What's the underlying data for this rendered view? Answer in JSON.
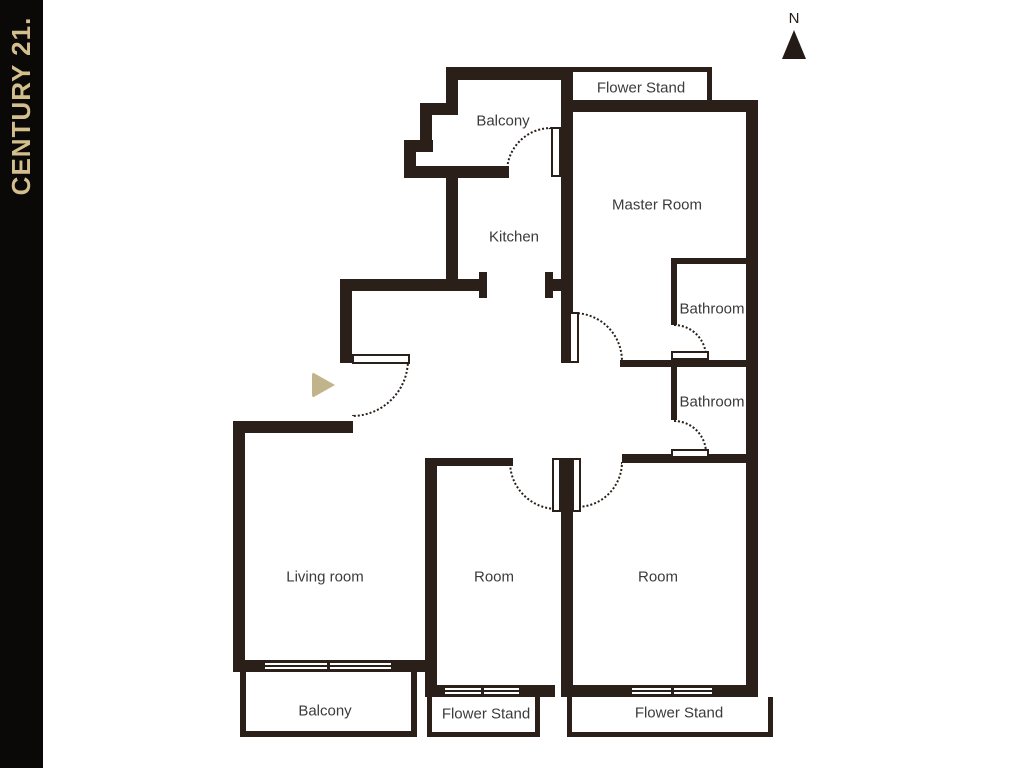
{
  "brand": {
    "text": "CENTURY 21.",
    "bar_color": "#0b0907",
    "text_color": "#d3bf8e"
  },
  "compass": {
    "label": "N"
  },
  "palette": {
    "wall": "#2b2019",
    "label_text": "#3b3b3b",
    "entrance_marker": "#c2b48a",
    "background": "#ffffff"
  },
  "labels": {
    "flower_stand_top": "Flower Stand",
    "balcony_top": "Balcony",
    "master_room": "Master Room",
    "kitchen": "Kitchen",
    "bathroom_upper": "Bathroom",
    "bathroom_lower": "Bathroom",
    "living_room": "Living room",
    "room_left": "Room",
    "room_right": "Room",
    "balcony_bottom": "Balcony",
    "flower_stand_bottom_left": "Flower Stand",
    "flower_stand_bottom_right": "Flower Stand"
  }
}
